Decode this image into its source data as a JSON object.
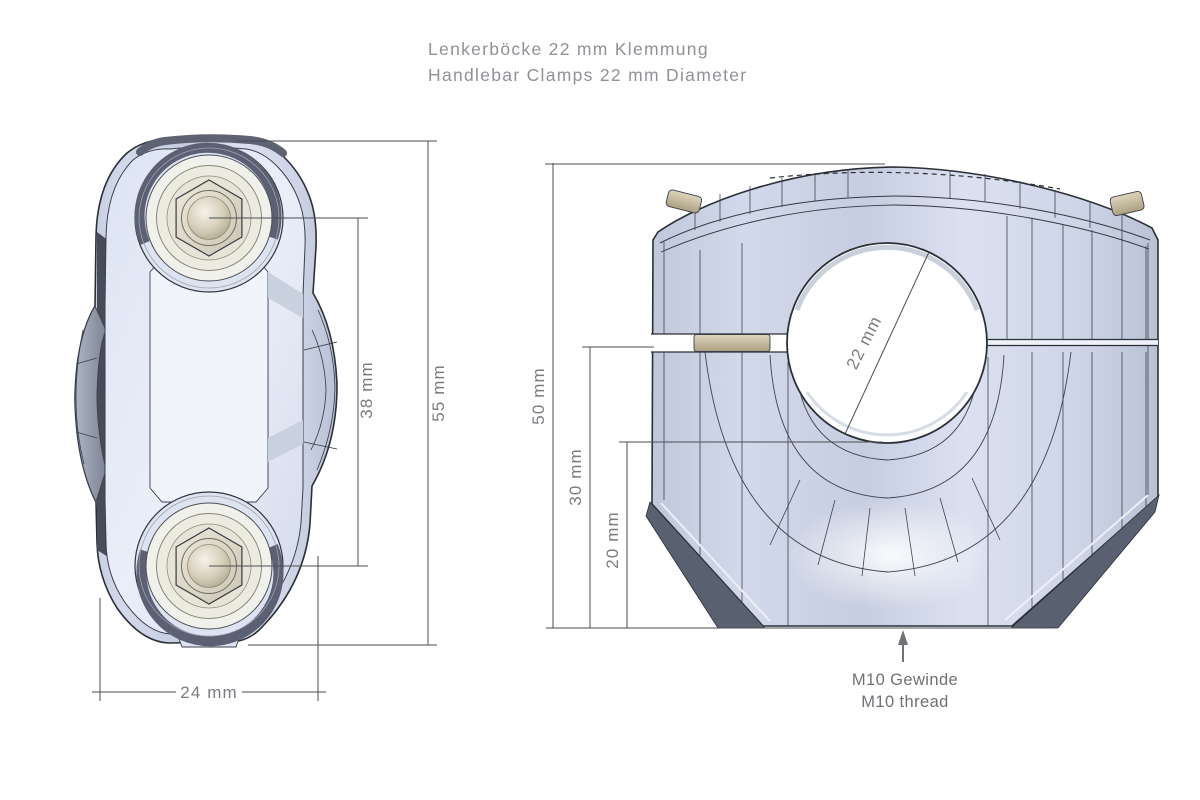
{
  "title": {
    "line1": "Lenkerböcke 22 mm Klemmung",
    "line2": "Handlebar Clamps 22 mm Diameter"
  },
  "top_view": {
    "dim_bolt_spacing": "38 mm",
    "dim_overall_length": "55 mm",
    "dim_width": "24 mm"
  },
  "front_view": {
    "dim_overall_height": "50 mm",
    "dim_clamp_axis_height": "30 mm",
    "dim_hole_bottom_height": "20 mm",
    "dim_bore_diameter": "22 mm",
    "thread_note_line1": "M10 Gewinde",
    "thread_note_line2": "M10 thread"
  },
  "colors": {
    "background": "#ffffff",
    "body_light": "#e7edf8",
    "body_mid": "#ccd4e6",
    "body_shadow": "#aab2c6",
    "edge_dark": "#596070",
    "outline": "#2b2f36",
    "spacer_tan": "#d2c9ae",
    "washer_cream": "#ecebdf",
    "dimension_line": "#4a4e54",
    "dimension_text": "#797d82",
    "title_text": "#8f9297"
  }
}
